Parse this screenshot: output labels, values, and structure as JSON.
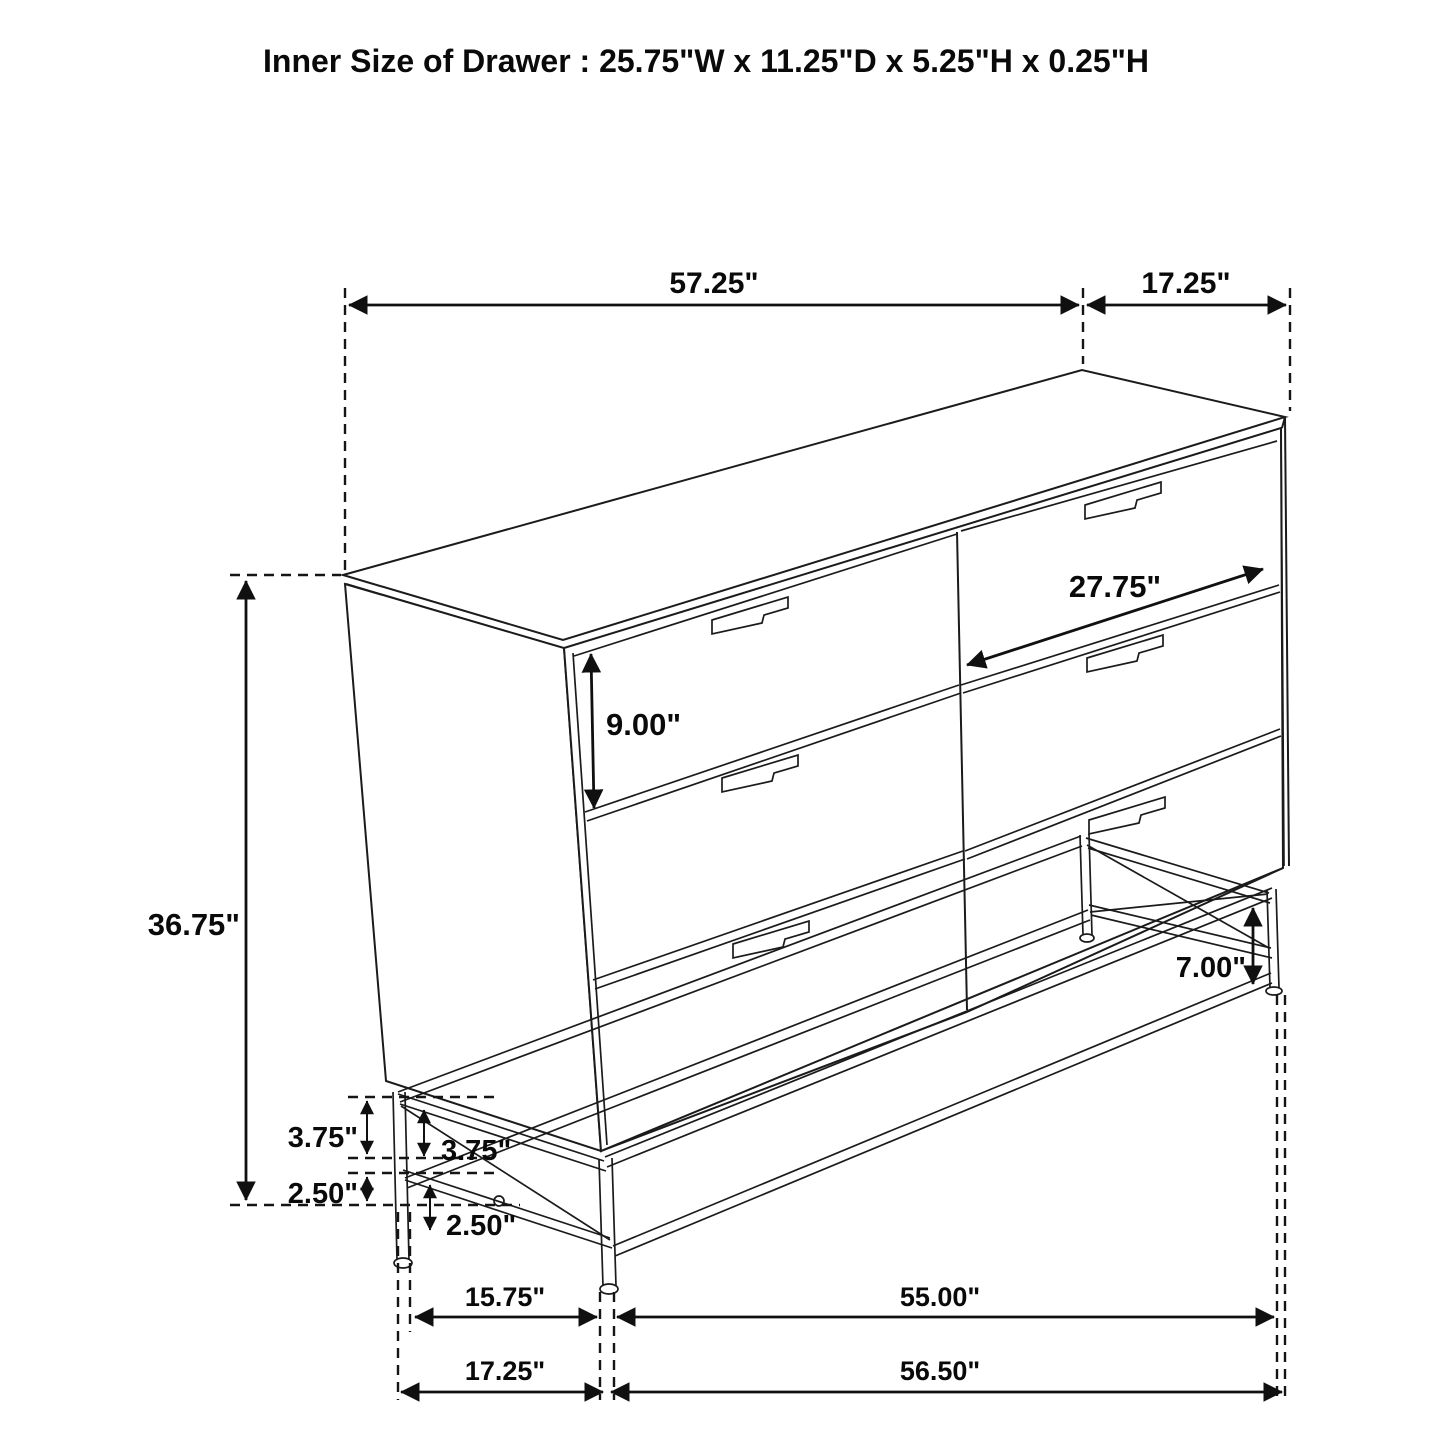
{
  "title": "Inner Size of Drawer : 25.75\"W x 11.25\"D x 5.25\"H x 0.25\"H",
  "diagram": {
    "object": "six-drawer dresser on metal leg frame",
    "style": "black-line perspective dimension drawing on white background",
    "line_color": "#1b1b1b",
    "background": "#ffffff",
    "dimensions": {
      "top_width": "57.25\"",
      "top_depth": "17.25\"",
      "overall_height": "36.75\"",
      "drawer_face_height": "9.00\"",
      "drawer_width": "27.75\"",
      "base_clearance_right": "7.00\"",
      "base_rail_upper_outer": "3.75\"",
      "base_rail_upper_inner": "3.75\"",
      "base_rail_lower_outer": "2.50\"",
      "base_rail_lower_inner": "2.50\"",
      "base_left_leg_span": "15.75\"",
      "base_front_inner_span": "55.00\"",
      "base_left_depth": "17.25\"",
      "base_front_overall": "56.50\""
    }
  }
}
